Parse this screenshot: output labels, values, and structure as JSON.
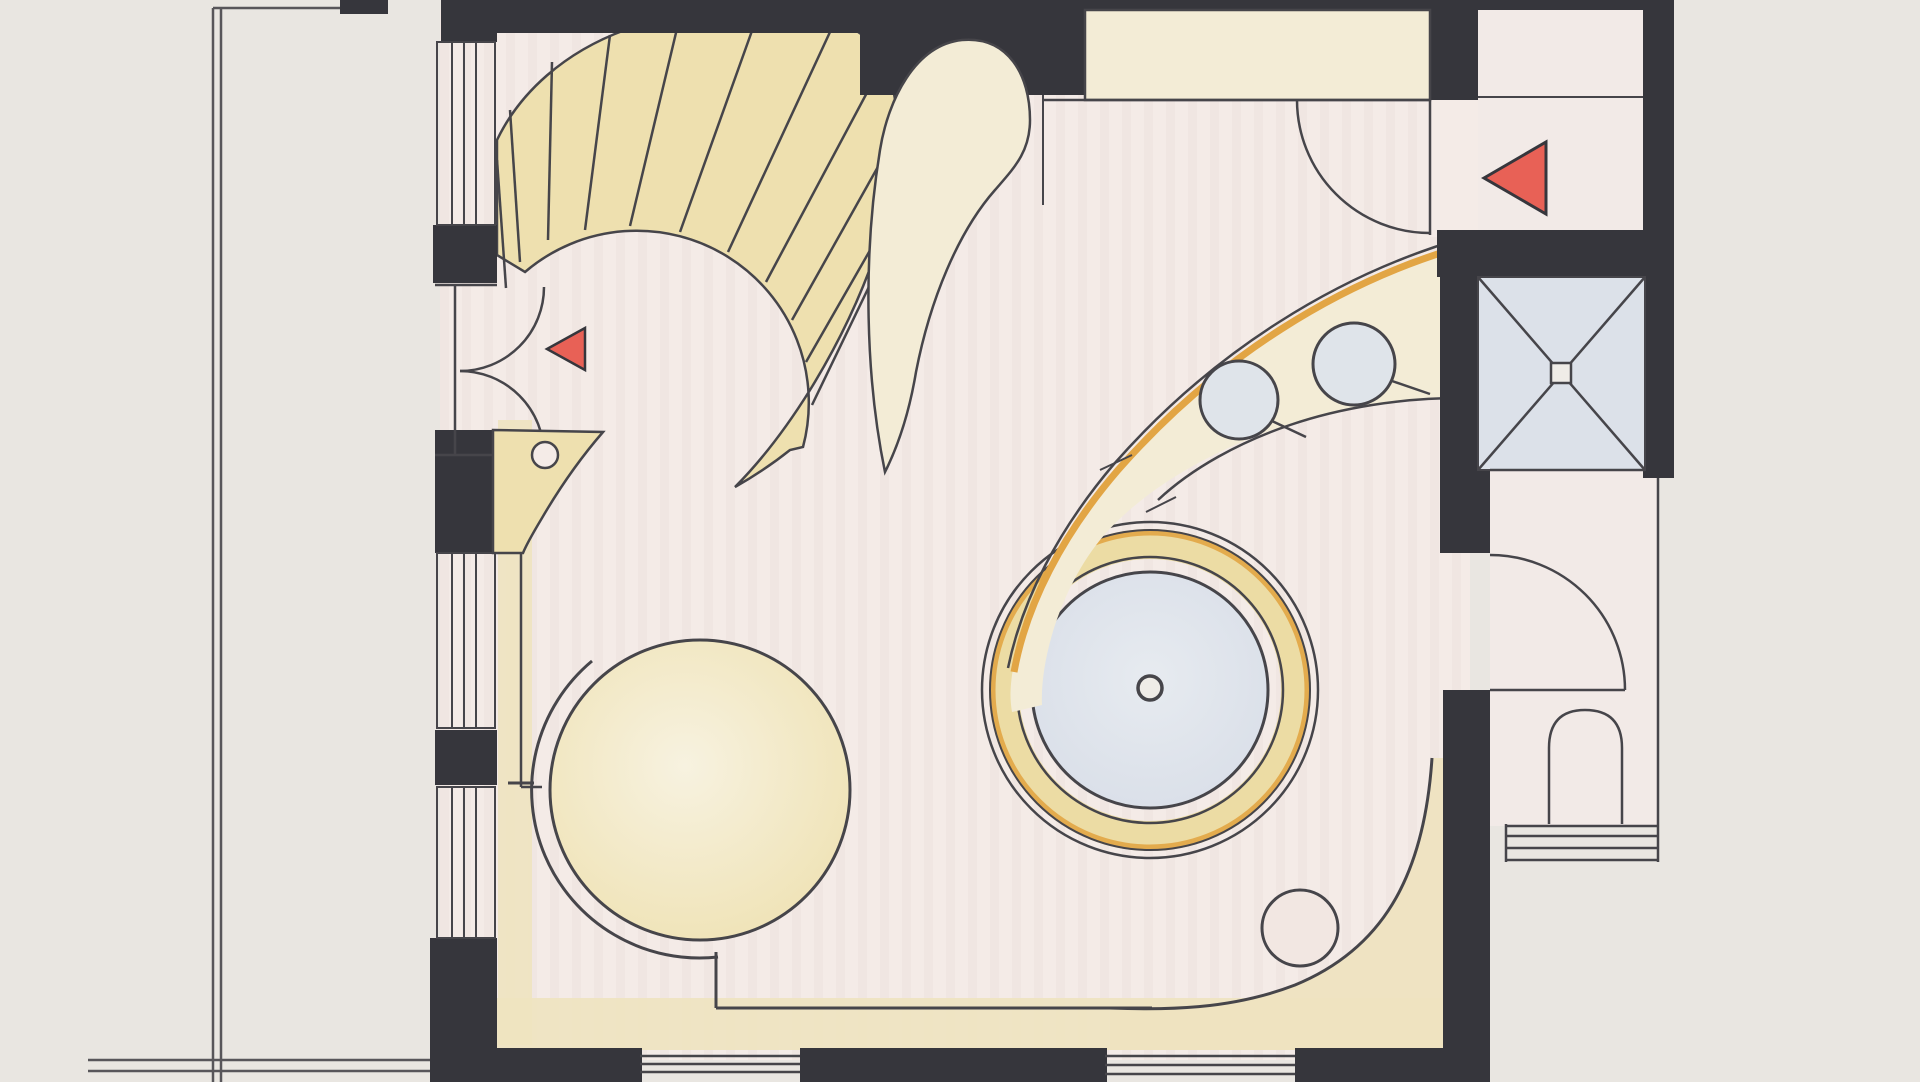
{
  "plan": {
    "kind": "hand-drawn-floor-plan",
    "features": [
      "terrace-outline",
      "window-wall",
      "entry-double-door",
      "spiral-staircase",
      "curved-balustrade",
      "wardrobe-counter",
      "entry-door-top",
      "entry-corridor",
      "bar-counter",
      "bar-stools",
      "whirlpool-tub",
      "round-bed",
      "vanity-shelf",
      "shower-cabin",
      "wc-room",
      "wc-fixture",
      "corner-curve",
      "floor-lamp-circle"
    ]
  },
  "colors": {
    "paper": "#e9e6e1",
    "floor": "#f4ebe7",
    "floorStripe": "#e3d4cf",
    "wall": "#36363c",
    "line": "#46454a",
    "tanStair": "#eee0af",
    "tanLight": "#f3ecd6",
    "tanStrip": "#eee3c0",
    "tanRing": "#ecdca4",
    "orange": "#e2a544",
    "blue": "#dfe4ea",
    "shower": "#dce1e9",
    "red": "#e86156",
    "bed": "#f4eed6",
    "paperHole": "#efece7"
  }
}
